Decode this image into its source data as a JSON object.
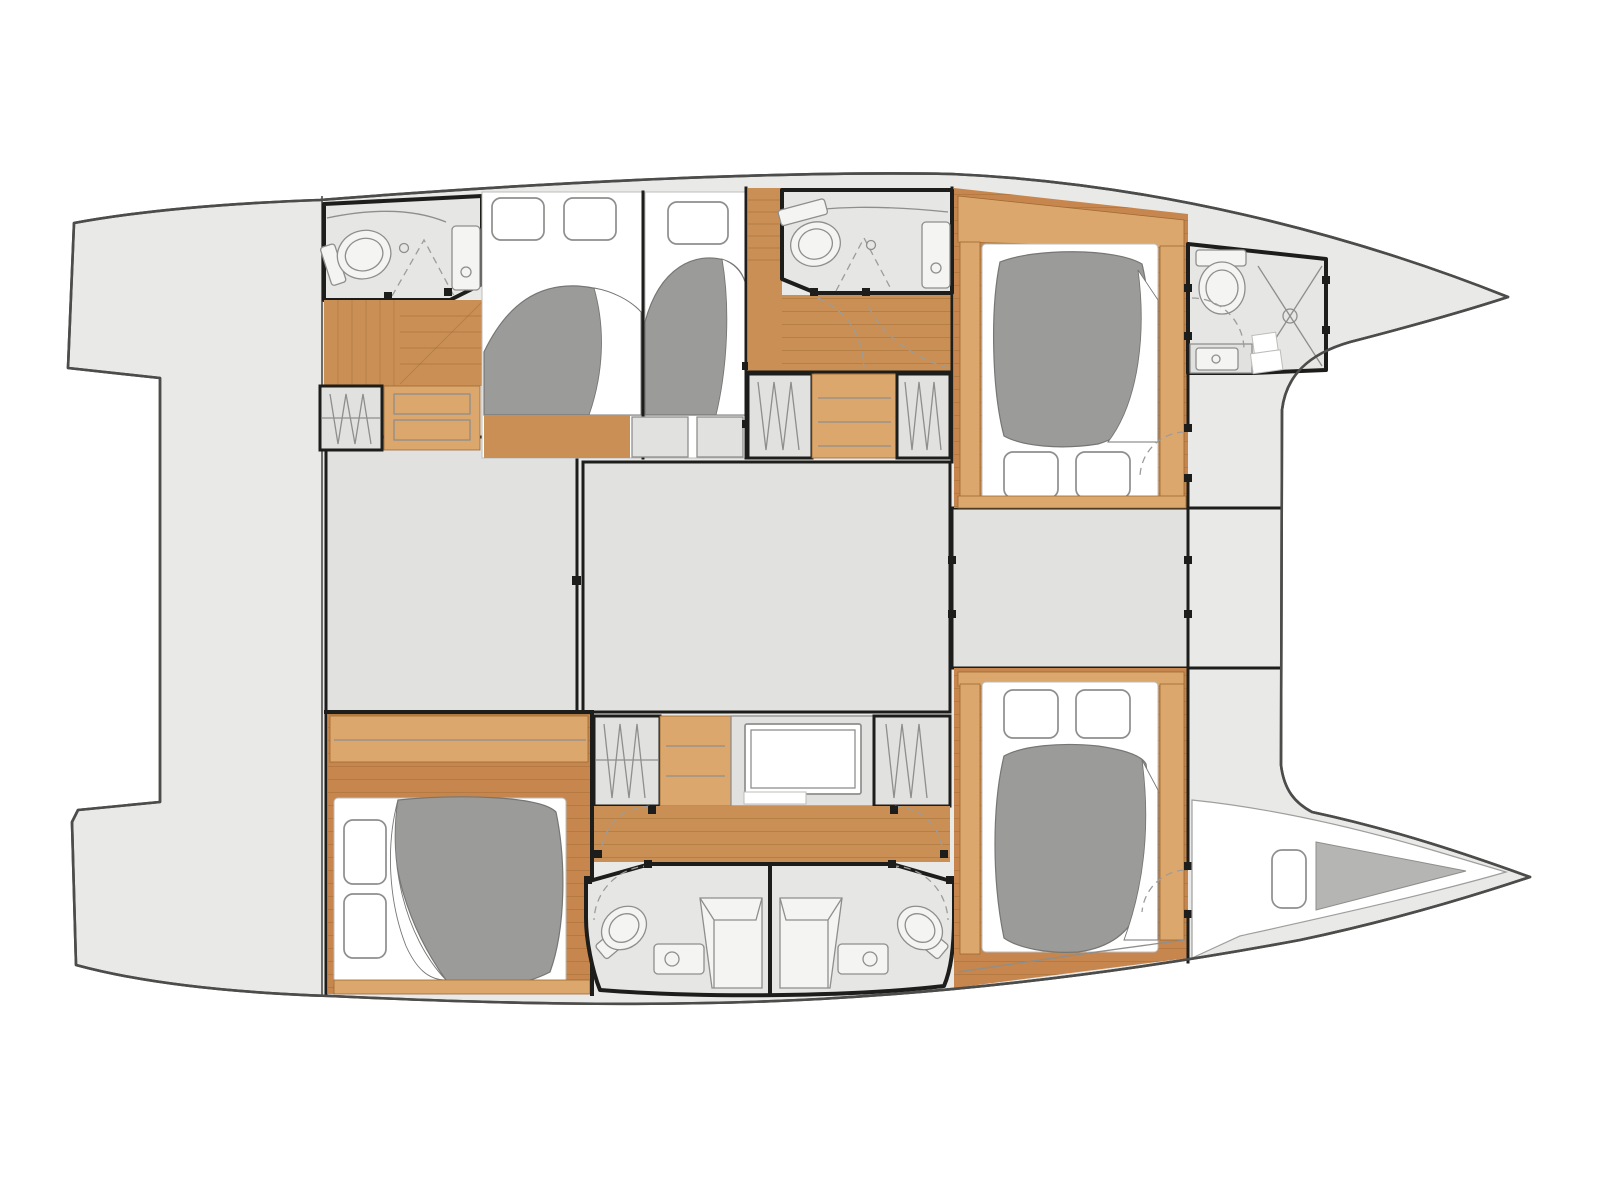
{
  "meta": {
    "title": "Catamaran yacht interior layout — deck floor plan",
    "type": "floor-plan"
  },
  "colors": {
    "background": "#ffffff",
    "deck": "#e9e9e8",
    "outline": "#4c4c4a",
    "panel": "#e1e1e0",
    "room": "#e6e6e4",
    "wall": "#1d1d1b",
    "line": "#8e8e8c",
    "wood": "#c98f55",
    "wood_floor": "#c6864d",
    "wood_light": "#dca76c",
    "wood_line": "#9c6a33",
    "duvet": "#9b9b9a",
    "duvet_edge": "#767674",
    "berth": "#b5b5b4",
    "dash": "#9c9c9a",
    "white": "#ffffff",
    "fixture": "#f4f4f3"
  },
  "areas": {
    "hulls": 2,
    "cabins": 5,
    "bathrooms": 5,
    "wardrobes": 5,
    "forepeak_berths": 1
  }
}
